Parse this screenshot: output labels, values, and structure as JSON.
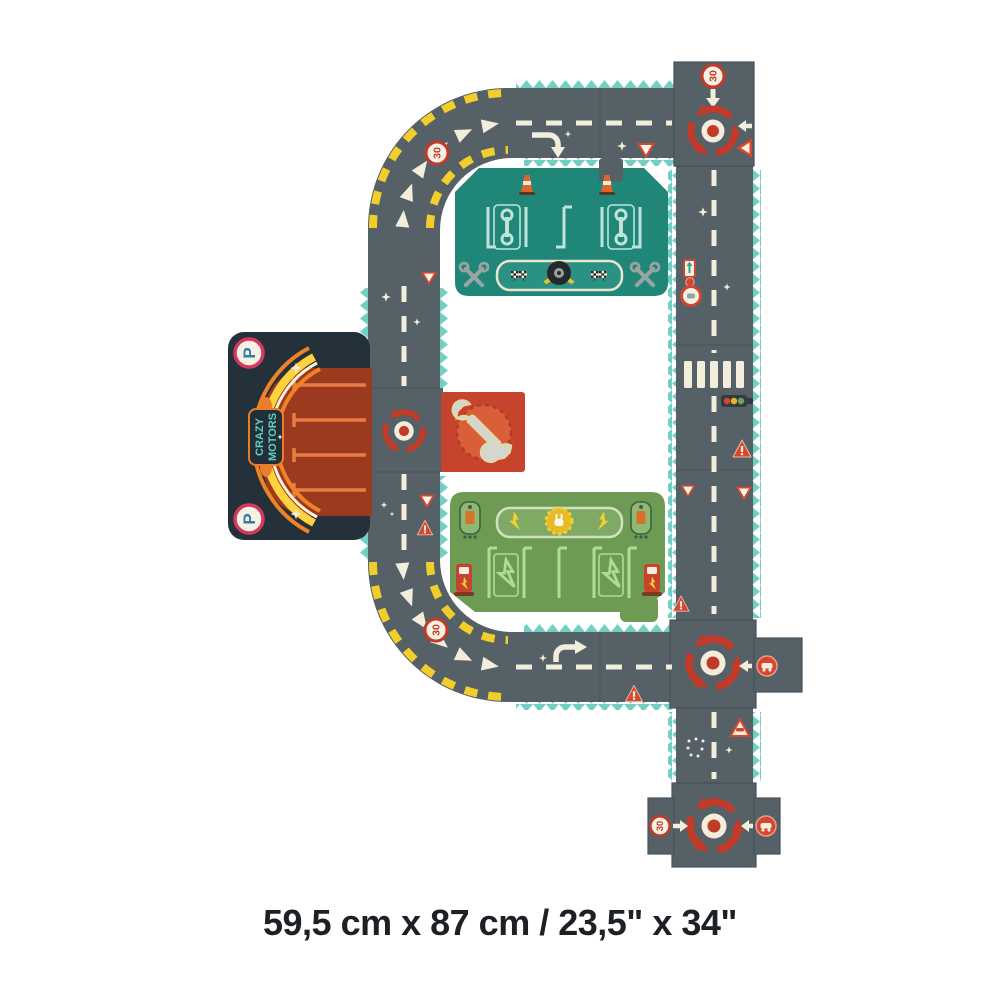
{
  "caption": "59,5 cm x 87 cm / 23,5\" x 34\"",
  "brand_logo": {
    "line1": "CRAZY",
    "line2": "MOTORS"
  },
  "signs": {
    "speed_limit": "30",
    "parking_letter": "P"
  },
  "icons": {
    "roundabout-icon": "circular red arrows with center dot",
    "wrench-icon": "diagonal double-ended wrench",
    "crossed-wrenches-icon": "two crossed wrenches",
    "tire-icon": "black tire with laurel wings",
    "checkered-flags-icon": "racing finish flags",
    "traffic-cone-icon": "orange striped cone",
    "charging-plug-icon": "plug in sun burst",
    "lightning-icon": "charging bolt",
    "charging-pump-icon": "red EV charger",
    "traffic-light-icon": "horizontal 3-lamp signal",
    "yield-sign-icon": "red outlined triangle",
    "warning-sign-icon": "red filled triangle with !",
    "crosswalk-icon": "white zebra bars",
    "turn-arrow-icon": "curved white arrow",
    "sparkle-icon": "four point star"
  },
  "colors": {
    "background": "#ffffff",
    "road": "#556067",
    "road_edge_teal": "#72cfc4",
    "marking_cream": "#f2eedb",
    "hazard_yellow": "#f1ce2b",
    "accent_red": "#c23b28",
    "sign_red": "#d2492f",
    "pit_teal": "#1f8678",
    "pit_light": "#bfe3da",
    "charge_green": "#6d9b53",
    "charge_light": "#aedd96",
    "parking_navy": "#25313a",
    "parking_red": "#9c3a20",
    "parking_orange": "#ef8325",
    "logo_teal": "#5fd0bf",
    "text_black": "#1d2126"
  }
}
